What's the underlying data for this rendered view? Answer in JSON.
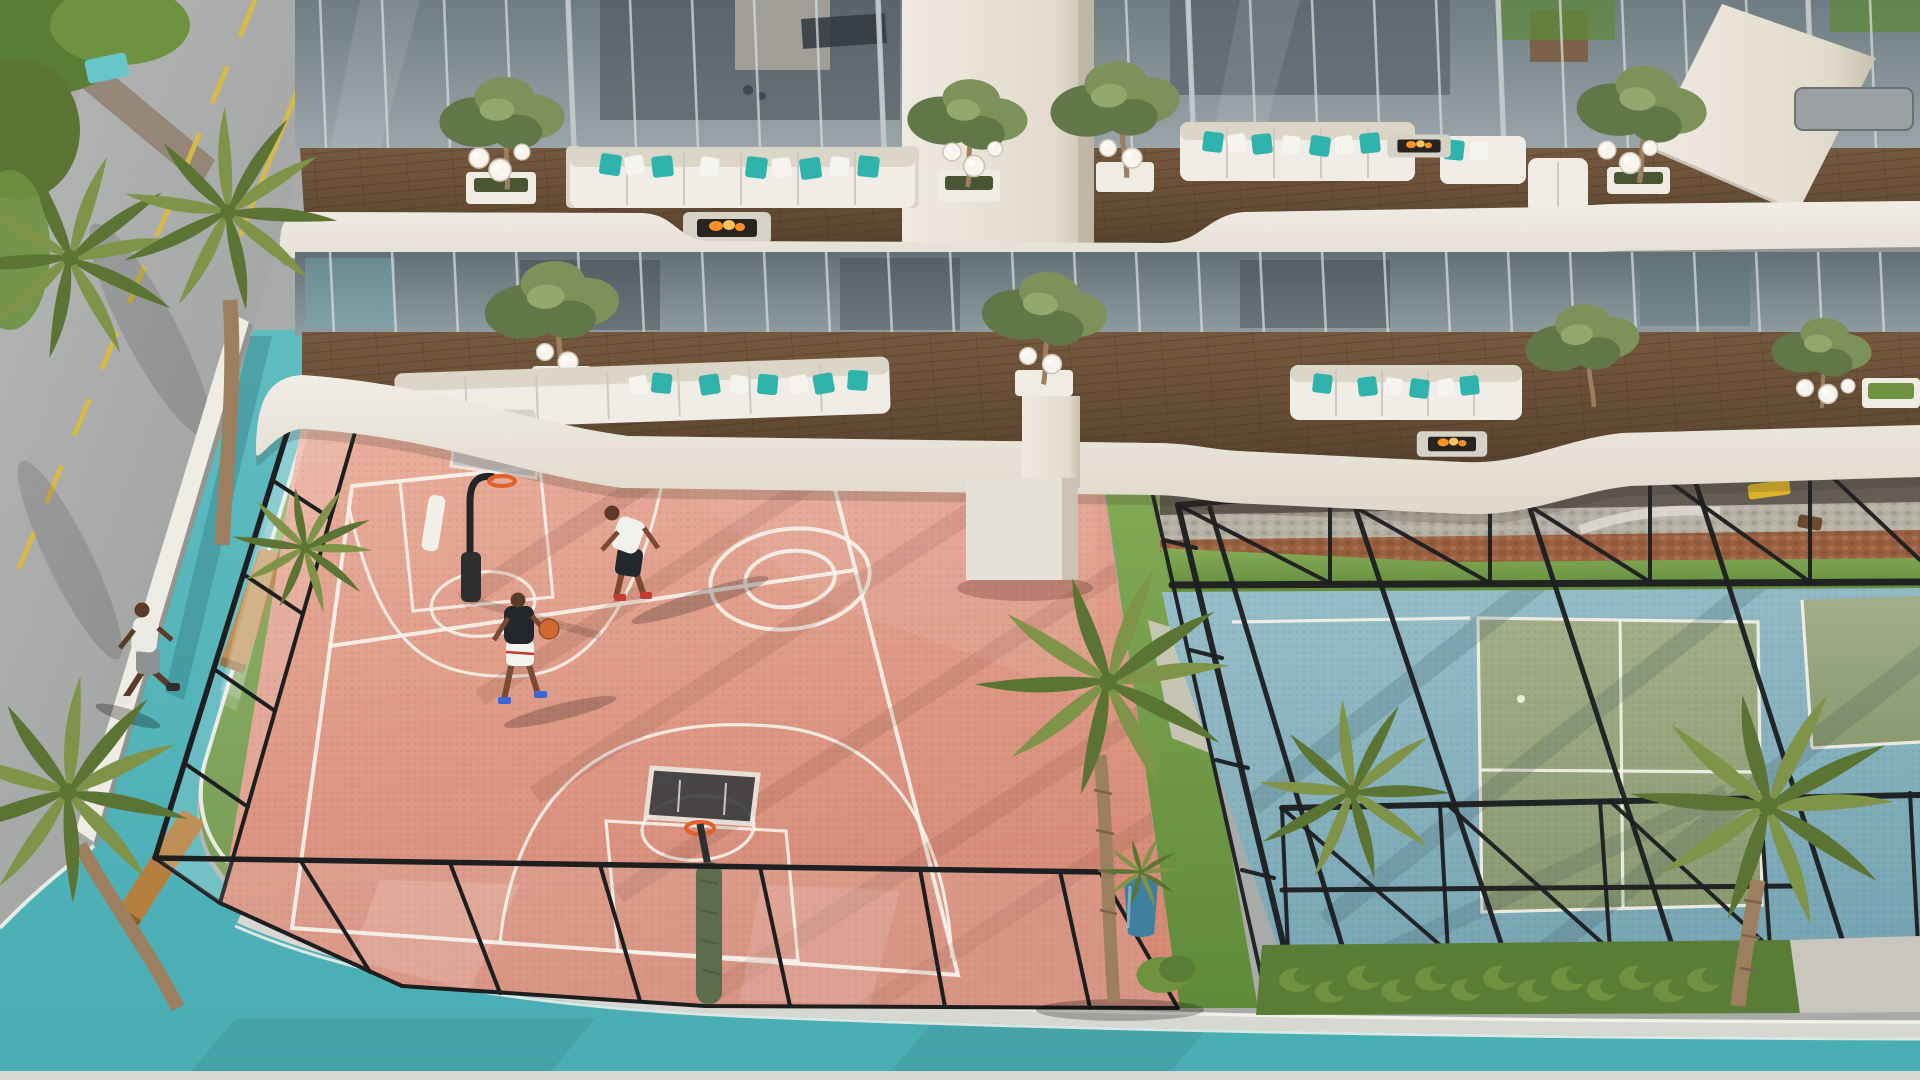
{
  "scene": {
    "type": "architectural-aerial-render",
    "description": "Aerial rendering of a residential tower podium: two furnished balcony levels with wavy white fascias above a salmon-pink basketball court and a caged blue-and-green padel court, ringed by a turquoise jogging track, gray street, palms, lawns and benches",
    "people": {
      "basketball_players": 2,
      "jogger": 1
    },
    "counts": {
      "palm_trees": 8,
      "balcony_trees": 8,
      "sofas": 6,
      "fire_tables": 4,
      "benches": 2,
      "hedge_bushes": 13,
      "basketballs": 1,
      "hoops": 2,
      "sunbeds": 1,
      "blue_pots": 1
    }
  },
  "palette": {
    "track": "#55b5bb",
    "track_light": "#6fc5c6",
    "track_dark": "#3f9aa2",
    "road": "#abadac",
    "road_dark": "#9a9c9b",
    "road_marking": "#d9ba42",
    "wall": "#efece4",
    "sidewalk": "#d9d7d1",
    "court_pink": "#df9a87",
    "court_pink_light": "#ecb7a4",
    "court_pink_dark": "#c97f6e",
    "court_line": "#f6f2ea",
    "padel_blue": "#8db7c1",
    "padel_blue_dark": "#74a2b0",
    "padel_green": "#9aa680",
    "padel_green_dark": "#87966d",
    "grass": "#7ca44e",
    "grass_dark": "#5a7d35",
    "hedge": "#6e9240",
    "palm": "#7f9448",
    "palm_dark": "#5c7433",
    "palm_trunk": "#9c7f5f",
    "tree": "#7d915a",
    "tree_dark": "#617747",
    "tree_light": "#93a86c",
    "wood": "#6b5138",
    "wood_dark": "#55402c",
    "bench_wood": "#b5803f",
    "fascia": "#ebe7df",
    "fascia_deep": "#ddd7ca",
    "glass": "#8a979d",
    "glass_dark": "#59646b",
    "glass_light": "#aeb9bc",
    "mullion": "#d5d9da",
    "pier": "#e9e4da",
    "pier_shade": "#c5bcab",
    "fence": "#1d1e20",
    "sofa": "#f0ede6",
    "sofa_shade": "#dcd6c9",
    "pillow_teal": "#2fb3ac",
    "pillow_white": "#f6f4ee",
    "flame": "#ff9028",
    "flame_light": "#ffc25e",
    "fire_table": "#d6d2c7",
    "fire_pit": "#27241f",
    "planter": "#efece4",
    "lamp": "#f7f5ee",
    "terracotta": "#9a5f3e",
    "cobble": "#b6b1a5",
    "sunbed": "#ddb32c",
    "pot_blue": "#3f7fa0",
    "skin": "#7a4a33",
    "skin_dark": "#5c3a28",
    "ball": "#d06a32",
    "pool": "#67c6c9"
  }
}
